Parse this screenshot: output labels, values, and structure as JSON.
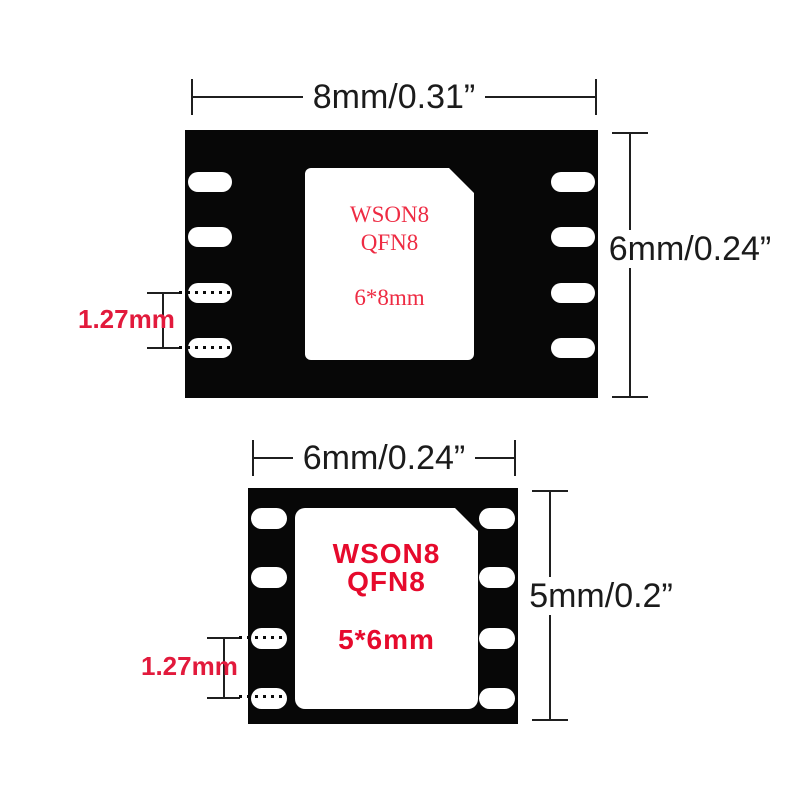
{
  "title": "WSON8 QFN8 adapter size diagram",
  "colors": {
    "background": "#ffffff",
    "chip_body": "#070707",
    "pad": "#ffffff",
    "dim_line": "#1f1f1f",
    "dim_text": "#1b1b1b",
    "annotation_red": "#e21a3c",
    "top_label_red": "#ee2b43",
    "bottom_label_red": "#e60a2c"
  },
  "top_chip": {
    "width_dim": "8mm/0.31”",
    "height_dim": "6mm/0.24”",
    "pitch_dim": "1.27mm",
    "line1": "WSON8",
    "line2": "QFN8",
    "line3": "6*8mm"
  },
  "bottom_chip": {
    "width_dim": "6mm/0.24”",
    "height_dim": "5mm/0.2”",
    "pitch_dim": "1.27mm",
    "line1": "WSON8",
    "line2": "QFN8",
    "line3": "5*6mm"
  }
}
